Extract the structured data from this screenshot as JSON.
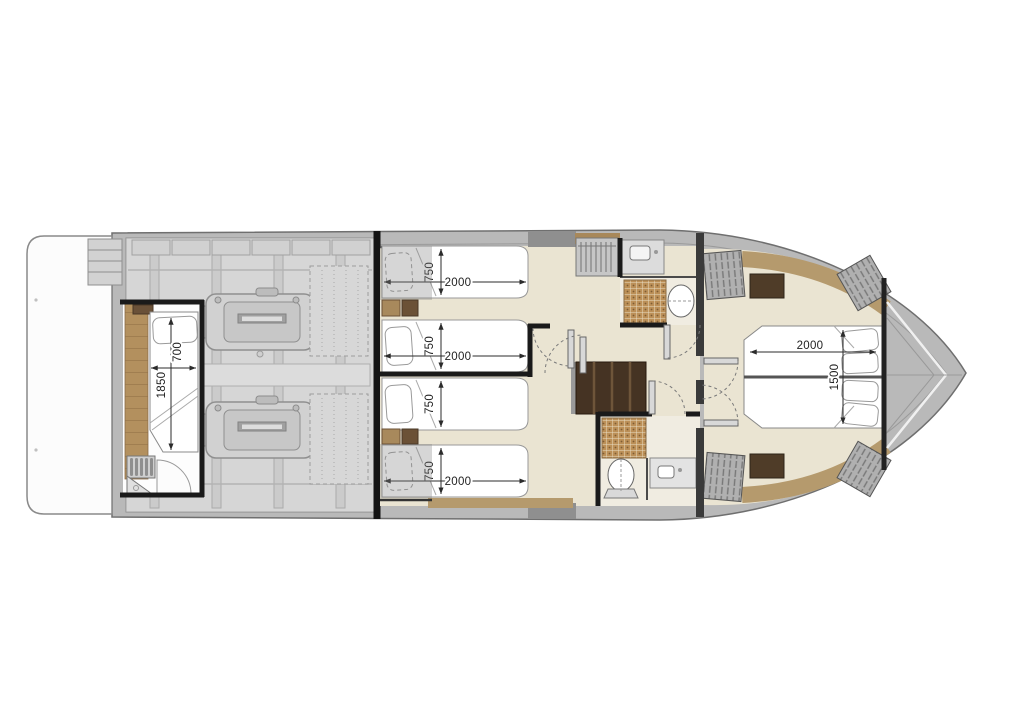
{
  "plan": {
    "dimensions": {
      "crew_cabin_bed": {
        "length_mm": "1850",
        "width_mm": "700"
      },
      "guest_cabin_beds": [
        {
          "width_mm": "750",
          "length_mm": "2000"
        },
        {
          "width_mm": "750",
          "length_mm": "2000"
        },
        {
          "width_mm": "750",
          "length_mm": null
        },
        {
          "width_mm": "750",
          "length_mm": "2000"
        }
      ],
      "master_bed": {
        "length_mm": "2000",
        "width_mm": "1500"
      }
    },
    "colors": {
      "hull_deck": "#b9b9b9",
      "interior_floor": "#eae4d2",
      "bathroom_floor": "#f0ece1",
      "teak_wood": "#b3905e",
      "tan_trim": "#b59a6d",
      "dark_wood": "#4f3c28",
      "stair_wood": "#453323",
      "mosaic_tile": "#bc9058",
      "wall": "#1a1a1a",
      "engine_room": "#cfcfcf",
      "bed_linen": "#ffffff"
    }
  }
}
